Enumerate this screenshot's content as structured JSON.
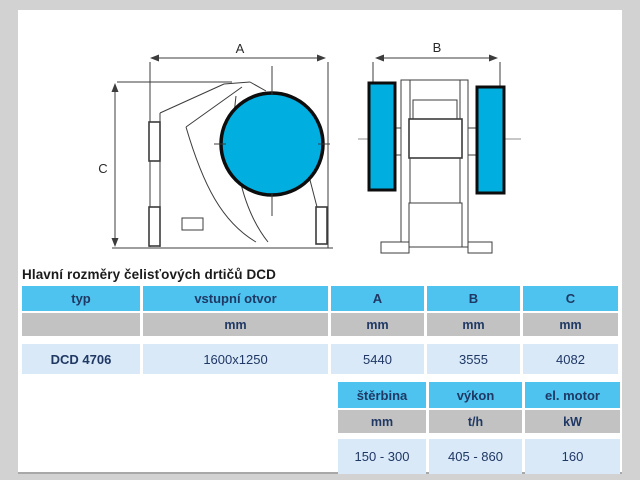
{
  "title": "Hlavní rozměry čelisťových drtičů DCD",
  "diagram": {
    "labels": {
      "a": "A",
      "b": "B",
      "c": "C"
    }
  },
  "main_table": {
    "headers": [
      "typ",
      "vstupní otvor",
      "A",
      "B",
      "C"
    ],
    "units": [
      "",
      "mm",
      "mm",
      "mm",
      "mm"
    ],
    "row": [
      "DCD 4706",
      "1600x1250",
      "5440",
      "3555",
      "4082"
    ]
  },
  "secondary_table": {
    "headers": [
      "štěrbina",
      "výkon",
      "el. motor"
    ],
    "units": [
      "mm",
      "t/h",
      "kW"
    ],
    "row": [
      "150 - 300",
      "405 - 860",
      "160"
    ]
  },
  "colors": {
    "header_blue": "#4EC3EF",
    "unit_gray": "#C2C2C2",
    "row_blue": "#D9E9F8",
    "accent_cyan": "#00AEE0",
    "text_navy": "#1F3864",
    "frame_gray": "#D2D2D2"
  }
}
